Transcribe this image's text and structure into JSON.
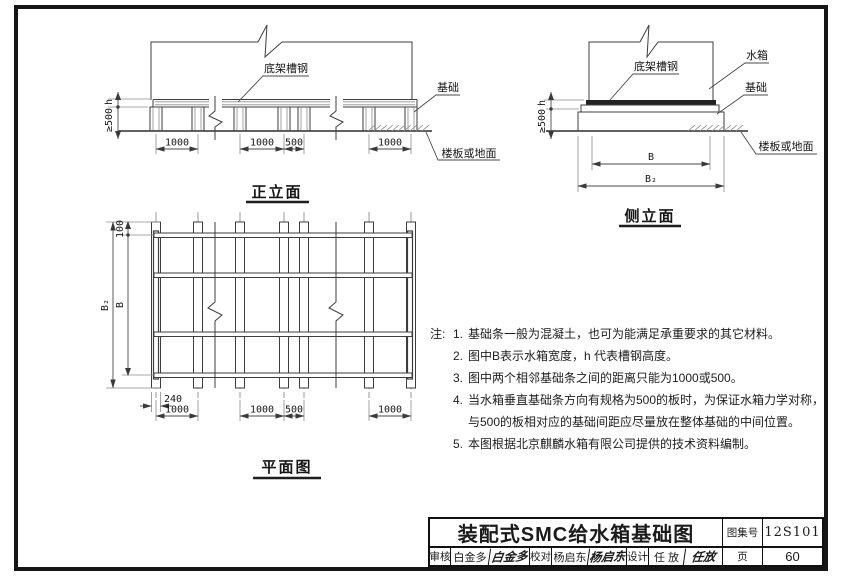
{
  "colors": {
    "ink": "#1b1b1b",
    "line": "#3d3d3d",
    "paper": "#ffffff"
  },
  "front": {
    "title": "正立面",
    "label_channel": "底架槽钢",
    "label_foundation": "基础",
    "label_floor": "楼板或地面",
    "dim_h": "h",
    "dim_500": "≥500",
    "dims": [
      "1000",
      "1000",
      "500",
      "1000"
    ]
  },
  "side": {
    "title": "侧立面",
    "label_channel": "底架槽钢",
    "label_tank": "水箱",
    "label_foundation": "基础",
    "label_floor": "楼板或地面",
    "dim_h": "h",
    "dim_500": "≥500",
    "dim_b": "B",
    "dim_b2": "B₂"
  },
  "plan": {
    "title": "平面图",
    "dim_100": "100",
    "dim_b": "B",
    "dim_b2": "B₂",
    "dim_240": "240",
    "dims": [
      "1000",
      "1000",
      "500",
      "1000"
    ]
  },
  "notes": {
    "heading": "注:",
    "items": [
      {
        "num": "1.",
        "text": "基础条一般为混凝土，也可为能满足承重要求的其它材料。"
      },
      {
        "num": "2.",
        "text": "图中B表示水箱宽度，h 代表槽钢高度。"
      },
      {
        "num": "3.",
        "text": "图中两个相邻基础条之间的距离只能为1000或500。"
      },
      {
        "num": "4.",
        "text": "当水箱垂直基础条方向有规格为500的板时，为保证水箱力学对称，",
        "text2": "与500的板相对应的基础间距应尽量放在整体基础的中间位置。"
      },
      {
        "num": "5.",
        "text": "本图根据北京麒麟水箱有限公司提供的技术资料编制。"
      }
    ]
  },
  "title_block": {
    "title": "装配式SMC给水箱基础图",
    "atlas_label": "图集号",
    "atlas_no": "12S101",
    "page_label": "页",
    "page_no": "60",
    "reviewer_label": "审核",
    "reviewer_name": "白金多",
    "reviewer_sig": "白金多",
    "checker_label": "校对",
    "checker_name": "杨启东",
    "checker_sig": "杨启东",
    "designer_label": "设计",
    "designer_name": "任 放",
    "designer_sig": "任放"
  }
}
